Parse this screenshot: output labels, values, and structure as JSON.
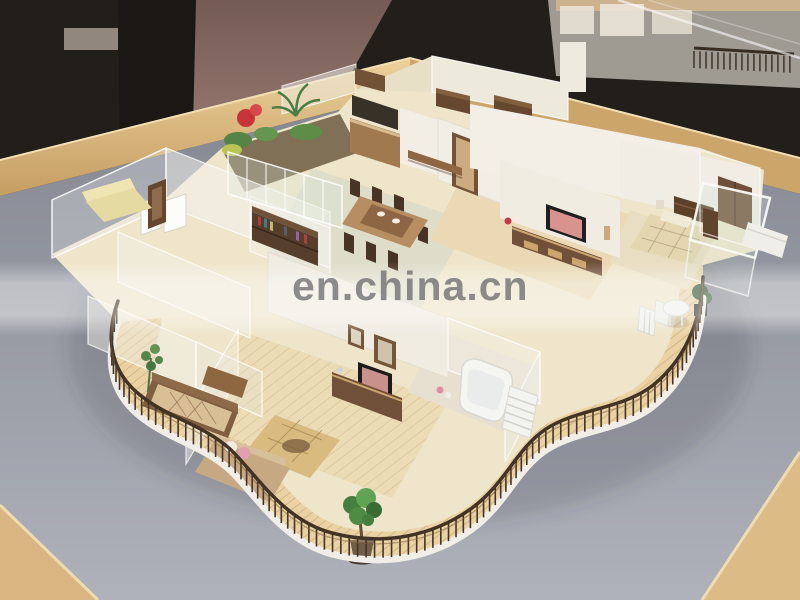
{
  "watermark": {
    "text": "en.china.cn"
  },
  "labels": {
    "photo": "Photograph of an architectural interior scale model displayed on a wooden table",
    "model": "miniature apartment model with frosted acrylic walls, furnished rooms and curved wooden balcony railing",
    "table": "light oak display table with grey baseboard",
    "background": "dark showroom background with second display model"
  },
  "palette": {
    "curb_white": "#f1efe7",
    "railing_brown": "#3a2a1b",
    "deck_wood": "#ead1a0",
    "interior_floor": "#efe5c9",
    "tile_floor": "#dcdcc8",
    "family_floor": "#eddcb4",
    "tv_cabinet": "#6b4830",
    "sofa_tan": "#c4a67e",
    "bench_cushion": "#d9bd92",
    "flower_red": "#c42b30",
    "foliage_green": "#3c7a34",
    "base_gray": "#8b8f99",
    "table_wood": "#d8b276"
  }
}
